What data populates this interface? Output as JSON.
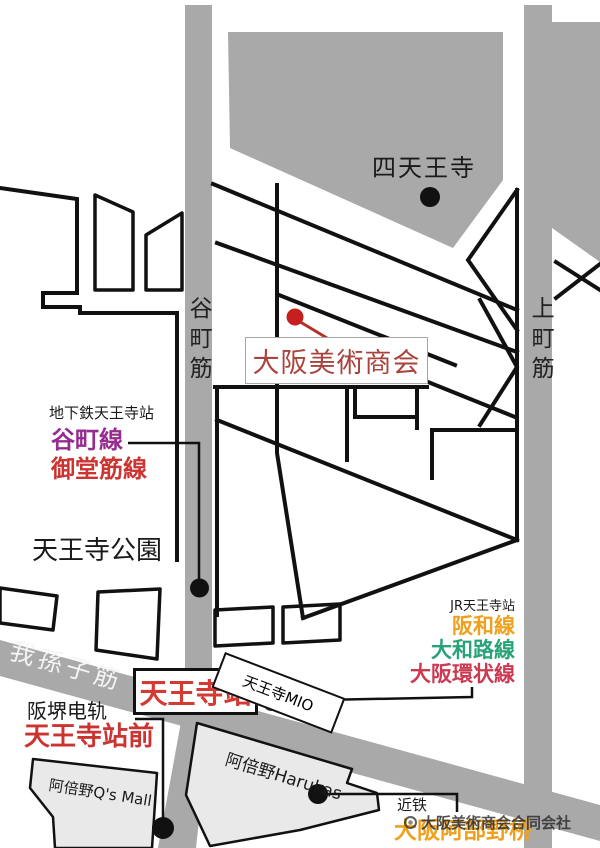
{
  "colors": {
    "road_gray": "#a9a9a9",
    "building_gray": "#e9e9e9",
    "street_black": "#111111",
    "destination_text_red": "#a8443c",
    "destination_marker_red": "#c5201f",
    "station_red": "#d43a31",
    "tanimachi_line_purple": "#952d8f",
    "midosuji_line_red": "#cb3431",
    "hanwa_line_orange": "#efa11d",
    "yamatoji_line_green": "#28a377",
    "loop_line_crimson": "#cb3a51",
    "abenobashi_orange": "#efa11d"
  },
  "roads": {
    "tanimachi_suji": "谷町筋",
    "uemachi_suji": "上町筋",
    "abiko_suji": "我孫子筋"
  },
  "landmarks": {
    "shitennoji": "四天王寺",
    "tennoji_park": "天王寺公園"
  },
  "destination": {
    "name": "大阪美術商会"
  },
  "subway": {
    "station_note": "地下鉄天王寺站",
    "lines": [
      "谷町線",
      "御堂筋線"
    ]
  },
  "jr": {
    "station_note": "JR天王寺站",
    "station_name": "天王寺站",
    "lines": [
      "阪和線",
      "大和路線",
      "大阪環状線"
    ]
  },
  "tram": {
    "company": "阪堺电轨",
    "station_name": "天王寺站前"
  },
  "kintetsu": {
    "company": "近铁",
    "station_name": "大阪阿部野桥"
  },
  "buildings": {
    "mio": "天王寺MIO",
    "harukas": "阿倍野Harukas",
    "qs_mall": "阿倍野Q's Mall"
  },
  "watermark": "大阪美術商会合同会社"
}
